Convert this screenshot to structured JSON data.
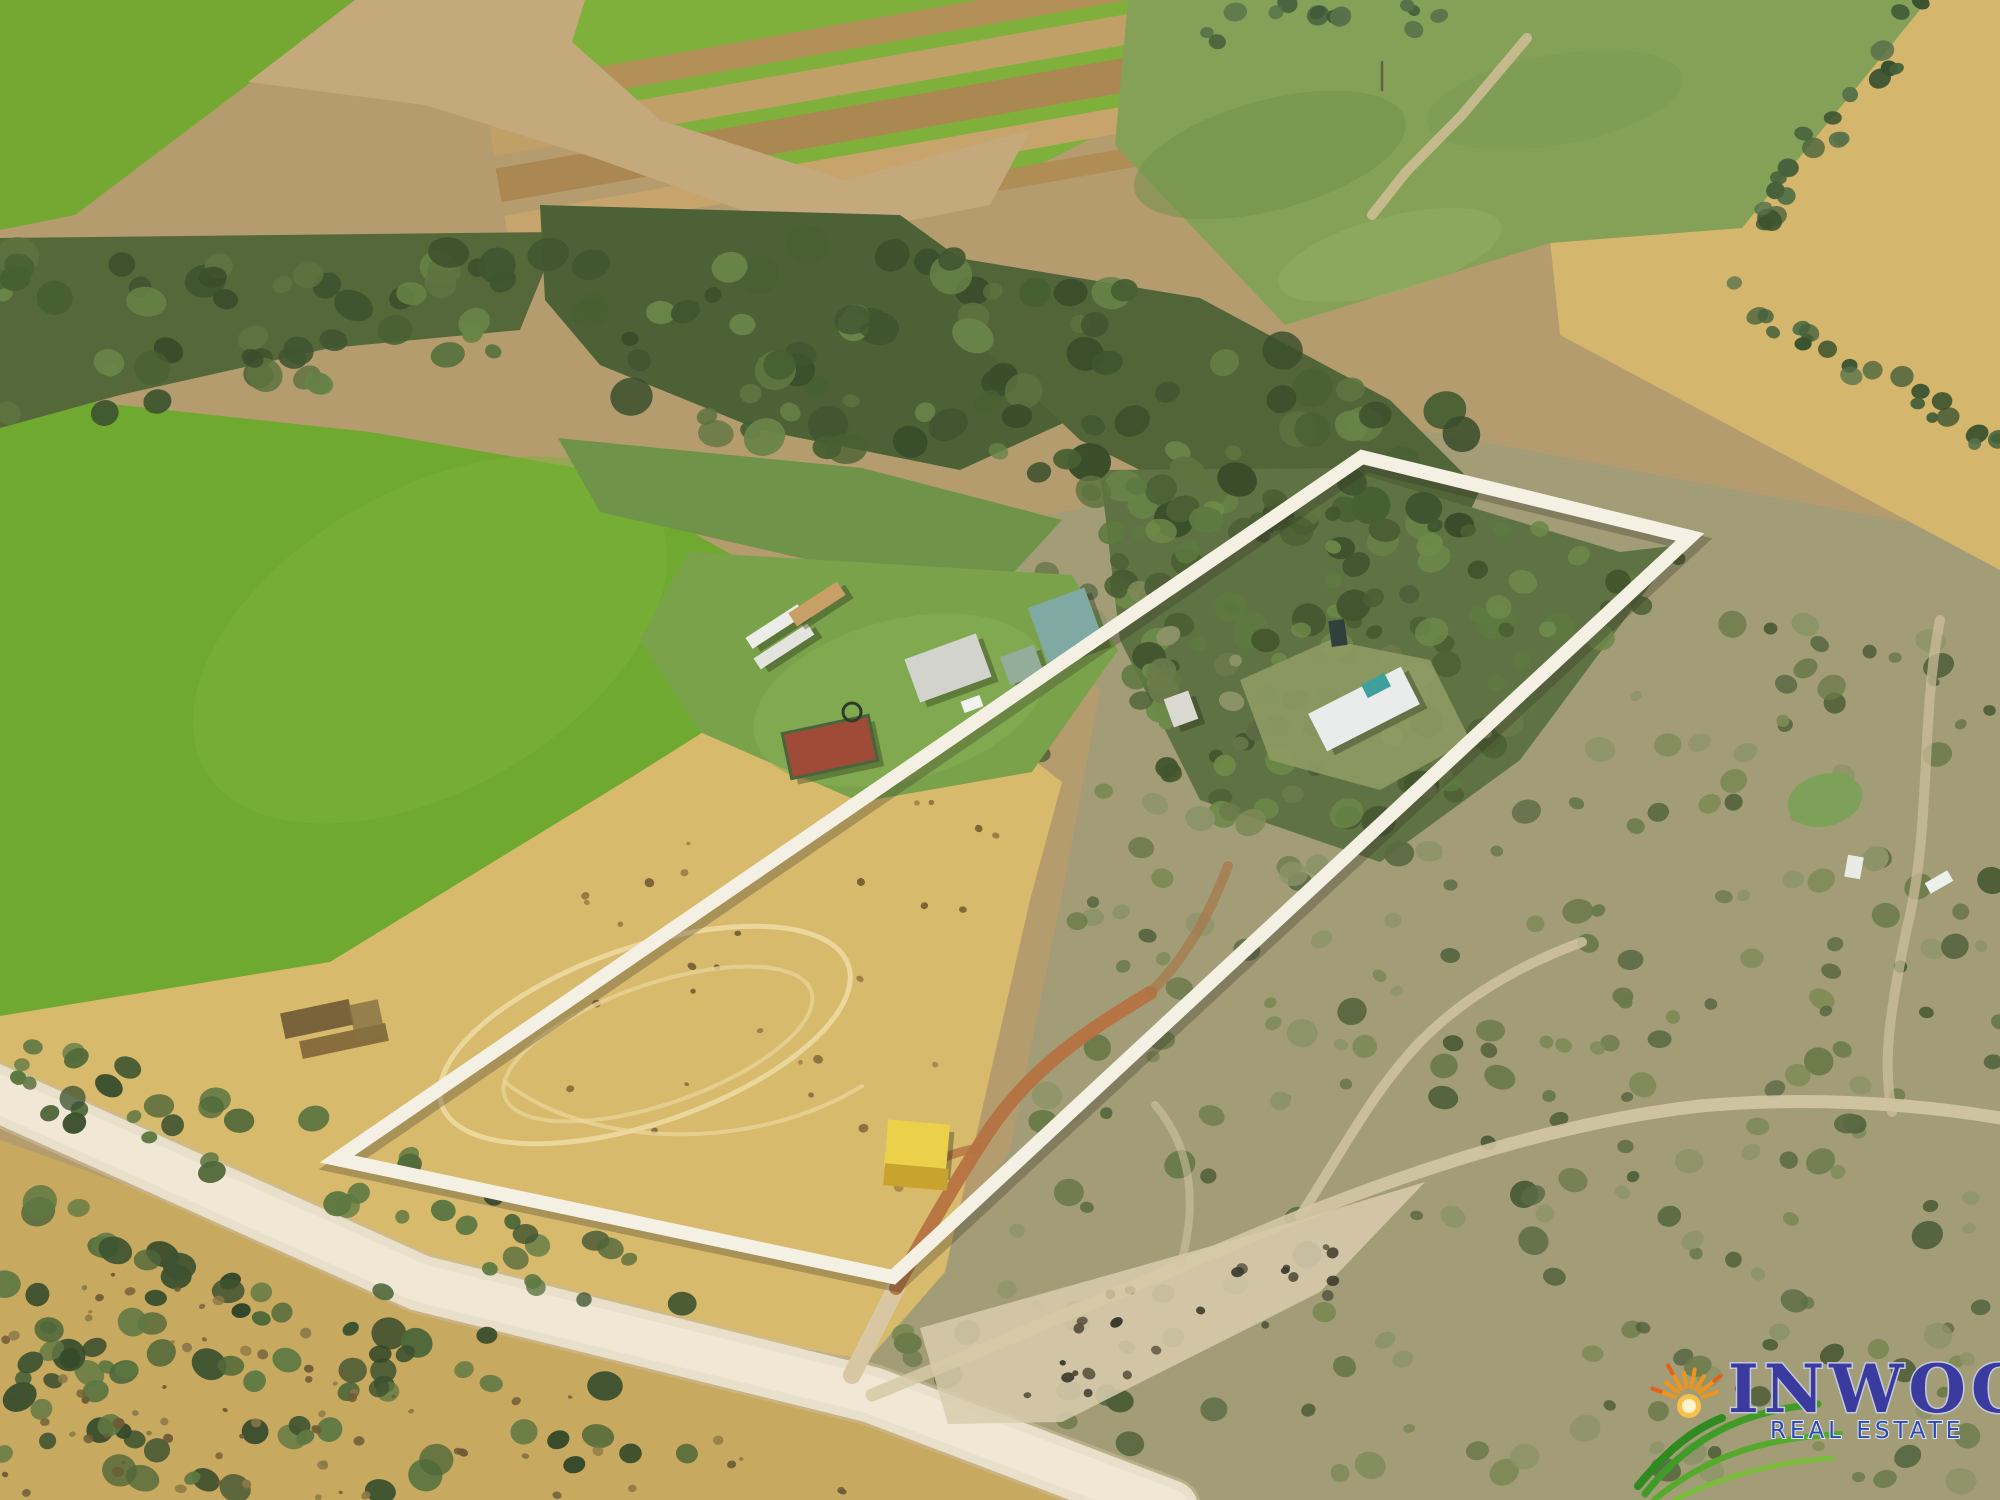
{
  "canvas": {
    "width": 2000,
    "height": 1500
  },
  "watermark": {
    "brand": "INWOOD",
    "tagline": "REAL ESTATE",
    "brand_color": "#3a3a9f",
    "brand_halo_color": "#c3cadf",
    "tagline_color": "#2e49b5",
    "tagline_halo_color": "#dfe5f2",
    "sun_color": "#f0951c",
    "grass_color": "#3f9c26"
  },
  "overlay": {
    "points": "1362,457 1690,537 893,1277 337,1159",
    "line_color": "#f4f0e4",
    "line_width": 14
  },
  "palette": {
    "turf_green": "#74a833",
    "irrigated_green": "#6fa92f",
    "pasture_green": "#85a158",
    "woodland_dark": "#4d6136",
    "dry_paddock_gold": "#d8ba6c",
    "crop_gold": "#d4b76d",
    "gravel_road": "#e9e0cb",
    "dirt_track_orange": "#b5713f",
    "container_yellow": "#ecd04a",
    "shed_teal": "#7fa9a2",
    "pens_red": "#a04a38"
  },
  "scene": {
    "layers": [
      {
        "t": "rect",
        "name": "base-ground",
        "x": 0,
        "y": 0,
        "w": 2000,
        "h": 1500,
        "fill": "#b49c6e"
      },
      {
        "t": "poly",
        "name": "scrub-ground-east",
        "pts": "940,540 1420,430 2000,540 2000,1500 990,1500 865,1360 1010,1150 1065,880 1100,690",
        "fill": "#a29d77"
      },
      {
        "t": "poly",
        "name": "golden-field-far-right",
        "pts": "1925,0 2000,0 2000,570 1560,335 1550,240 1742,228",
        "fill": "#d4b76d"
      },
      {
        "t": "poly",
        "name": "turf-field-corner",
        "pts": "0,0 360,0 75,215 0,230",
        "fill": "#74a833"
      },
      {
        "t": "poly",
        "name": "turf-strip-field",
        "pts": "575,0 1295,0 1240,62 975,198 840,180 655,118 568,40",
        "fill": "#7fb03c"
      },
      {
        "t": "rect",
        "name": "turf-strip-brown-1",
        "x": 477,
        "y": 11,
        "w": 880,
        "h": 26,
        "rot": -10,
        "fill": "#b39057"
      },
      {
        "t": "rect",
        "name": "turf-strip-brown-2",
        "x": 485,
        "y": 50,
        "w": 880,
        "h": 30,
        "rot": -10,
        "fill": "#c0a067"
      },
      {
        "t": "rect",
        "name": "turf-strip-brown-3",
        "x": 492,
        "y": 92,
        "w": 880,
        "h": 34,
        "rot": -10,
        "fill": "#ab8752"
      },
      {
        "t": "rect",
        "name": "turf-strip-brown-4",
        "x": 500,
        "y": 139,
        "w": 880,
        "h": 26,
        "rot": -10,
        "fill": "#c6a46c"
      },
      {
        "t": "rect",
        "name": "turf-strip-brown-5",
        "x": 507,
        "y": 180,
        "w": 880,
        "h": 20,
        "rot": -10,
        "fill": "#b08d55"
      },
      {
        "t": "poly",
        "name": "headland-dirt-road",
        "pts": "355,0 585,0 572,42 660,120 845,180 1030,130 990,205 820,238 595,158 425,105 248,82",
        "fill": "#c4a97c"
      },
      {
        "t": "poly",
        "name": "pasture-top-right",
        "pts": "1128,0 1928,0 1742,228 1550,243 1285,325 1115,145",
        "fill": "#85a158"
      },
      {
        "t": "ellipse",
        "name": "pasture-wash-1",
        "cx": 1270,
        "cy": 155,
        "rx": 140,
        "ry": 55,
        "rot": -15,
        "fill": "#73924c",
        "op": 0.55
      },
      {
        "t": "ellipse",
        "name": "pasture-wash-2",
        "cx": 1555,
        "cy": 100,
        "rx": 130,
        "ry": 45,
        "rot": -10,
        "fill": "#7a9a50",
        "op": 0.5
      },
      {
        "t": "ellipse",
        "name": "pasture-wash-3",
        "cx": 1390,
        "cy": 255,
        "rx": 115,
        "ry": 38,
        "rot": -15,
        "fill": "#93b065",
        "op": 0.5
      },
      {
        "t": "path",
        "name": "eroded-creek-line",
        "d": "M1527,38 L1462,115 L1406,172 L1372,215",
        "stroke": "#ccbd92",
        "sw": 10,
        "op": 0.9
      },
      {
        "t": "path",
        "name": "power-pole",
        "d": "M1382,62 L1382,90",
        "stroke": "#5a5a4a",
        "sw": 2.5,
        "op": 0.9
      },
      {
        "t": "poly",
        "name": "irrigated-field-west",
        "pts": "0,392 370,432 578,468 865,630 640,772 330,962 0,1016",
        "fill": "#6fa92f"
      },
      {
        "t": "ellipse",
        "name": "field-west-wash",
        "cx": 430,
        "cy": 640,
        "rx": 260,
        "ry": 150,
        "rot": -30,
        "fill": "#7db23b",
        "op": 0.5
      },
      {
        "t": "poly",
        "name": "dry-paddock",
        "pts": "865,630 1062,782 1030,900 945,1272 868,1360 420,1282 120,1132 0,1085 0,1016 330,962 640,772",
        "fill": "#d8ba6c"
      },
      {
        "t": "poly",
        "name": "golden-grass-south",
        "pts": "0,1140 420,1290 870,1400 1160,1510 0,1510",
        "fill": "#c9aa5f",
        "op": 0.95
      },
      {
        "t": "poly",
        "name": "wood-belt-west",
        "pts": "0,238 560,232 520,330 330,348 120,395 0,428",
        "fill": "#55683a"
      },
      {
        "t": "poly",
        "name": "wood-belt-center",
        "pts": "540,205 900,215 1010,295 1070,420 960,470 760,430 600,365 545,300",
        "fill": "#4d6136"
      },
      {
        "t": "poly",
        "name": "wood-belt-east",
        "pts": "940,255 1200,298 1390,400 1480,490 1440,575 1260,530 1080,440 975,340",
        "fill": "#516539"
      },
      {
        "t": "poly",
        "name": "wood-ne-inside-boundary",
        "pts": "1100,470 1340,468 1620,552 1680,545 1520,760 1380,862 1200,800 1120,640",
        "fill": "#5e7243"
      },
      {
        "t": "poly",
        "name": "creek-grass-strip",
        "pts": "558,438 862,468 1062,520 1002,585 818,562 600,512",
        "fill": "#6f9348"
      },
      {
        "t": "scatter",
        "name": "trees-main-belt",
        "region": "0,235 900,240 1200,300 1480,420 1480,580 1150,520 800,450 400,380 0,425",
        "n": 150,
        "rmin": 8,
        "rmax": 22,
        "colors": [
          "#3f5530",
          "#476032",
          "#5d7440",
          "#394d2b",
          "#688447"
        ],
        "seed": 7
      },
      {
        "t": "scatter",
        "name": "trees-ne-property",
        "region": "1080,462 1700,548 1480,800 1300,880 1150,800",
        "n": 120,
        "rmin": 7,
        "rmax": 18,
        "colors": [
          "#4a5f33",
          "#5d7a40",
          "#42552e",
          "#6d8a49"
        ],
        "seed": 11
      },
      {
        "t": "scatter",
        "name": "scrub-bushes-east",
        "region": "960,560 2000,630 2000,1490 1000,1470 890,1340 1030,1150 1075,900",
        "n": 270,
        "rmin": 6,
        "rmax": 16,
        "colors": [
          "#6b7a4a",
          "#5a6a44",
          "#7d8a56",
          "#4e5e38",
          "#8d9468"
        ],
        "seed": 23
      },
      {
        "t": "scatter",
        "name": "tree-row-right-upper",
        "region": "1900,0 1960,0 1775,235 1722,245",
        "n": 20,
        "rmin": 7,
        "rmax": 13,
        "colors": [
          "#46603a",
          "#39512e",
          "#57714a"
        ],
        "seed": 31
      },
      {
        "t": "scatter",
        "name": "tree-row-right-mid",
        "region": "1695,255 2000,425 2000,458 1690,288",
        "n": 22,
        "rmin": 6,
        "rmax": 12,
        "colors": [
          "#46603a",
          "#39512e",
          "#57714a"
        ],
        "seed": 37
      },
      {
        "t": "scatter",
        "name": "trees-top-edge",
        "region": "1150,0 1460,0 1420,58 1180,40",
        "n": 13,
        "rmin": 6,
        "rmax": 12,
        "colors": [
          "#41583a",
          "#57714a"
        ],
        "seed": 41
      },
      {
        "t": "scatter",
        "name": "dry-paddock-specks",
        "region": "430,830 880,700 1000,810 950,1240 600,1150",
        "n": 36,
        "rmin": 2,
        "rmax": 5,
        "colors": [
          "#9a7c45",
          "#7a6234"
        ],
        "seed": 43
      },
      {
        "t": "poly",
        "name": "homestead-lawn",
        "pts": "688,552 1072,575 1118,650 1032,772 860,802 700,732 640,640",
        "fill": "#7aa24b"
      },
      {
        "t": "ellipse",
        "name": "lawn-wash",
        "cx": 900,
        "cy": 700,
        "rx": 150,
        "ry": 80,
        "rot": -15,
        "fill": "#86ad52",
        "op": 0.6
      },
      {
        "t": "poly",
        "name": "cottage-clearing",
        "pts": "1240,680 1330,640 1430,660 1470,740 1380,790 1270,760",
        "fill": "#8f9b64",
        "op": 0.9
      },
      {
        "t": "ellipse",
        "name": "tire-track-oval-outer",
        "cx": 645,
        "cy": 1035,
        "rx": 215,
        "ry": 88,
        "rot": -19,
        "stroke": "#ecd79e",
        "sw": 5,
        "fill": "none",
        "op": 0.95
      },
      {
        "t": "ellipse",
        "name": "tire-track-oval-inner",
        "cx": 658,
        "cy": 1044,
        "rx": 162,
        "ry": 60,
        "rot": -19,
        "stroke": "#e7d093",
        "sw": 4,
        "fill": "none",
        "op": 0.85
      },
      {
        "t": "path",
        "name": "tire-track-arc",
        "d": "M505,1082 C590,1150 755,1152 862,1086",
        "stroke": "#ecd79e",
        "sw": 4,
        "op": 0.7
      },
      {
        "t": "rect",
        "name": "old-ruins-1",
        "x": 282,
        "y": 1006,
        "w": 70,
        "h": 26,
        "rot": -12,
        "fill": "#6e5a36",
        "op": 0.9
      },
      {
        "t": "rect",
        "name": "old-ruins-2",
        "x": 300,
        "y": 1032,
        "w": 88,
        "h": 18,
        "rot": -12,
        "fill": "#7a6034",
        "op": 0.85
      },
      {
        "t": "rect",
        "name": "old-ruins-3",
        "x": 352,
        "y": 1002,
        "w": 30,
        "h": 38,
        "rot": -12,
        "fill": "#857044",
        "op": 0.8
      },
      {
        "t": "path",
        "name": "gravel-road-edge",
        "d": "M-15,1088 L420,1283 L872,1395 L1170,1508",
        "stroke": "#cbbb97",
        "sw": 62,
        "op": 0.6
      },
      {
        "t": "path",
        "name": "gravel-road",
        "d": "M-15,1088 L420,1283 L872,1395 L1170,1508",
        "stroke": "#e9e0cb",
        "sw": 56
      },
      {
        "t": "path",
        "name": "gravel-road-center",
        "d": "M-15,1088 L420,1283 L872,1395 L1170,1508",
        "stroke": "#f1e9d7",
        "sw": 38,
        "op": 0.85
      },
      {
        "t": "poly",
        "name": "junction-clearing",
        "pts": "920,1328 1240,1238 1425,1182 1320,1292 1062,1422 948,1424",
        "fill": "#d9cdae",
        "op": 0.85
      },
      {
        "t": "scatter",
        "name": "junction-rocks",
        "region": "960,1330 1380,1225 1310,1320 1040,1428",
        "n": 24,
        "rmin": 3,
        "rmax": 7,
        "colors": [
          "#55503c",
          "#3e3c2e"
        ],
        "seed": 61
      },
      {
        "t": "path",
        "name": "driveway-junction",
        "d": "M852,1375 L896,1288",
        "stroke": "#d9c7a4",
        "sw": 18
      },
      {
        "t": "path",
        "name": "dirt-driveway-orange",
        "d": "M896,1288 C926,1232 958,1178 988,1132 C1032,1066 1092,1028 1150,993",
        "stroke": "#b5713f",
        "sw": 14,
        "op": 0.92
      },
      {
        "t": "path",
        "name": "dirt-driveway-north",
        "d": "M1150,993 C1188,956 1210,912 1228,866",
        "stroke": "#a8764a",
        "sw": 10,
        "op": 0.7
      },
      {
        "t": "path",
        "name": "container-spur",
        "d": "M978,1148 C955,1152 935,1160 918,1170",
        "stroke": "#b5713f",
        "sw": 9,
        "op": 0.8
      },
      {
        "t": "path",
        "name": "scrub-track-1",
        "d": "M872,1395 C1020,1335 1180,1266 1300,1216 C1420,1168 1560,1122 1700,1106 C1800,1097 1905,1102 2000,1118",
        "stroke": "#d7c9a6",
        "sw": 13,
        "op": 0.85
      },
      {
        "t": "path",
        "name": "scrub-track-2",
        "d": "M1300,1216 C1342,1152 1372,1092 1420,1042 C1468,993 1528,962 1582,942",
        "stroke": "#d3c5a2",
        "sw": 10,
        "op": 0.8
      },
      {
        "t": "path",
        "name": "scrub-track-3",
        "d": "M1940,620 C1920,720 1932,830 1906,932 C1890,1012 1882,1062 1892,1112",
        "stroke": "#cfc19c",
        "sw": 10,
        "op": 0.7
      },
      {
        "t": "path",
        "name": "scrub-track-loop",
        "d": "M1180,1266 C1198,1205 1192,1148 1155,1105",
        "stroke": "#d3c5a2",
        "sw": 8,
        "op": 0.55
      },
      {
        "t": "scatter",
        "name": "trees-roadside-north",
        "region": "0,1030 220,1075 560,1215 760,1300 600,1330 260,1190 0,1100",
        "n": 45,
        "rmin": 7,
        "rmax": 16,
        "colors": [
          "#3d5230",
          "#50683a",
          "#5e7842"
        ],
        "seed": 47
      },
      {
        "t": "scatter",
        "name": "trees-bottom-left",
        "region": "0,1170 420,1300 740,1442 520,1500 0,1500",
        "n": 85,
        "rmin": 8,
        "rmax": 18,
        "colors": [
          "#3d5230",
          "#50683a",
          "#5e7842",
          "#33482a"
        ],
        "seed": 53
      },
      {
        "t": "scatter",
        "name": "grass-speckles-south",
        "region": "120,1270 700,1430 1040,1500 0,1500 0,1300",
        "n": 70,
        "rmin": 2,
        "rmax": 6,
        "colors": [
          "#8a7747",
          "#6e5c38"
        ],
        "seed": 59
      },
      {
        "t": "rect",
        "name": "main-house",
        "x": 910,
        "y": 645,
        "w": 76,
        "h": 46,
        "rot": -20,
        "fill": "#d2d3cd",
        "shadow": 1
      },
      {
        "t": "rect",
        "name": "garage-shed",
        "x": 1004,
        "y": 650,
        "w": 36,
        "h": 30,
        "rot": -20,
        "fill": "#94ac9a",
        "shadow": 1
      },
      {
        "t": "rect",
        "name": "big-teal-shed",
        "x": 1036,
        "y": 596,
        "w": 60,
        "h": 58,
        "rot": -20,
        "fill": "#7fa9a2",
        "shadow": 1
      },
      {
        "t": "rect",
        "name": "stock-pens-red",
        "x": 786,
        "y": 724,
        "w": 88,
        "h": 46,
        "rot": -12,
        "fill": "#a04a38",
        "shadow": 1,
        "stroke": "#47663c",
        "sw": 3
      },
      {
        "t": "rect",
        "name": "white-trailer-1",
        "x": 744,
        "y": 620,
        "w": 62,
        "h": 13,
        "rot": -33,
        "fill": "#ecece8",
        "shadow": 1
      },
      {
        "t": "rect",
        "name": "white-trailer-2",
        "x": 752,
        "y": 640,
        "w": 64,
        "h": 13,
        "rot": -33,
        "fill": "#e4e4de",
        "shadow": 1
      },
      {
        "t": "rect",
        "name": "tan-trailer",
        "x": 788,
        "y": 596,
        "w": 58,
        "h": 16,
        "rot": -33,
        "fill": "#c89f66",
        "shadow": 1
      },
      {
        "t": "rect",
        "name": "white-car",
        "x": 962,
        "y": 698,
        "w": 20,
        "h": 12,
        "rot": -20,
        "fill": "#f2f2ee"
      },
      {
        "t": "ellipse",
        "name": "tire-swing-ring",
        "cx": 852,
        "cy": 712,
        "rx": 9,
        "ry": 9,
        "fill": "none",
        "stroke": "#2f3a28",
        "sw": 3
      },
      {
        "t": "rect",
        "name": "cottage-in-boundary",
        "x": 1312,
        "y": 688,
        "w": 104,
        "h": 42,
        "rot": -27,
        "fill": "#e9ecea",
        "shadow": 1
      },
      {
        "t": "rect",
        "name": "cottage-pool",
        "x": 1363,
        "y": 678,
        "w": 26,
        "h": 15,
        "rot": -27,
        "fill": "#3f9f9c"
      },
      {
        "t": "rect",
        "name": "dark-car",
        "x": 1330,
        "y": 620,
        "w": 16,
        "h": 26,
        "rot": -8,
        "fill": "#30403c"
      },
      {
        "t": "rect",
        "name": "caravan",
        "x": 1168,
        "y": 694,
        "w": 26,
        "h": 30,
        "rot": -20,
        "fill": "#d9d9d2",
        "shadow": 1
      },
      {
        "t": "rect",
        "name": "yellow-container-top",
        "x": 886,
        "y": 1122,
        "w": 62,
        "h": 48,
        "rot": 5,
        "fill": "#ecd04a",
        "shadow": 1
      },
      {
        "t": "rect",
        "name": "yellow-container-side",
        "x": 884,
        "y": 1166,
        "w": 64,
        "h": 22,
        "rot": 5,
        "fill": "#c8a42e"
      },
      {
        "t": "ellipse",
        "name": "waterhole",
        "cx": 1825,
        "cy": 800,
        "rx": 38,
        "ry": 26,
        "rot": -15,
        "fill": "#79a254",
        "op": 0.9
      },
      {
        "t": "rect",
        "name": "white-vehicle-east-1",
        "x": 1926,
        "y": 876,
        "w": 26,
        "h": 12,
        "rot": -30,
        "fill": "#eef0ee"
      },
      {
        "t": "rect",
        "name": "white-vehicle-east-2",
        "x": 1846,
        "y": 856,
        "w": 16,
        "h": 22,
        "rot": 10,
        "fill": "#e8eae6"
      }
    ]
  }
}
